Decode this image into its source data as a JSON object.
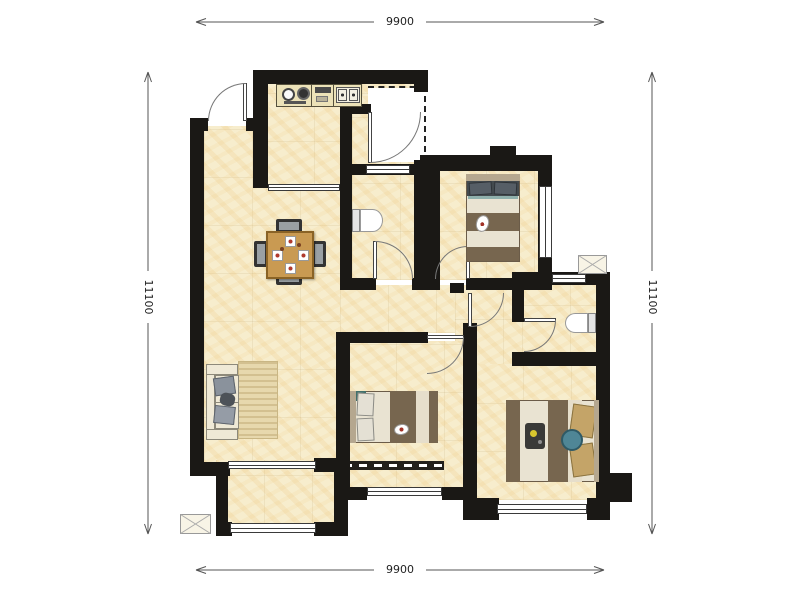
{
  "dimensions": {
    "top": "9900",
    "bottom": "9900",
    "left": "11100",
    "right": "11100"
  },
  "palette": {
    "wall": "#1a1815",
    "floor": "#f7edcd",
    "floor_vein": "#eccb82",
    "wood_table": "#c99a52",
    "blanket_brown": "#77664f",
    "bedding": "#e9e3d2",
    "rug": "#e7d8ad",
    "teal_cushion": "#4f8696",
    "pillow_tan": "#c4a468",
    "dimension_line": "#555555"
  },
  "symbols": {
    "shaft": "crossed-box-icon",
    "door": "quarter-arc-swing",
    "window": "multi-line-glazing"
  }
}
